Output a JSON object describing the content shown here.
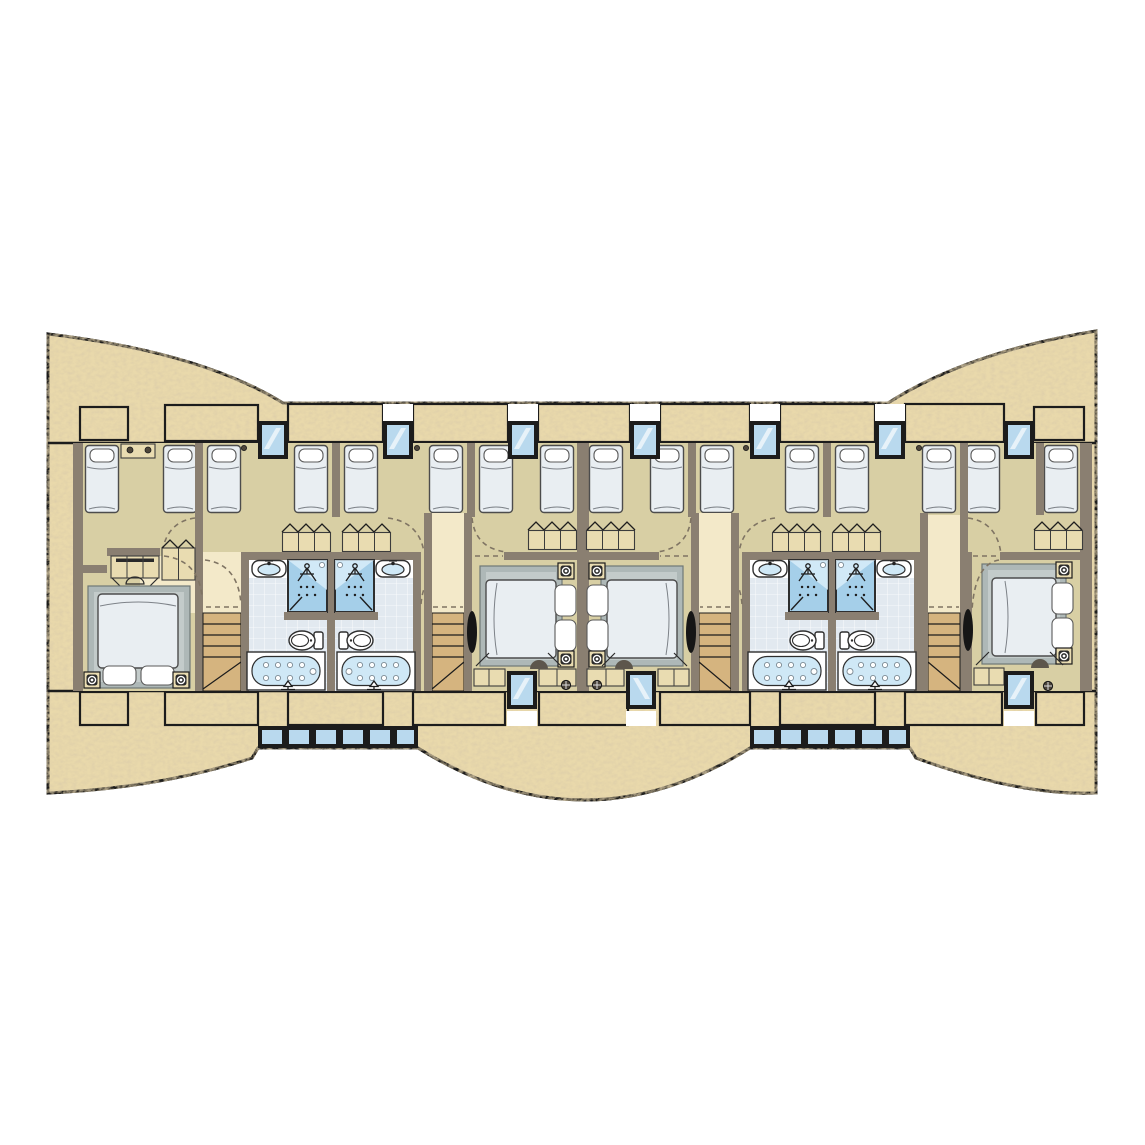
{
  "document": {
    "kind": "architectural-floor-plan",
    "level": "chalet bedroom storey",
    "aria": "Floor plan of a terraced chalet bedroom level with four units",
    "units": 4
  },
  "colors": {
    "paper": "#ffffff",
    "line": "#1c1c1c",
    "sand": "#e9d9ab",
    "sanddk": "#bfa273",
    "wall": "#8a7f71",
    "floor": "#d8cfa4",
    "corridor": "#f3e9c9",
    "stair": "#d5b47f",
    "tile": "#e2e9f0",
    "glass": "#b9d9ee",
    "tub": "#cfe8f6",
    "shower": "#a5cfe9",
    "bed": "#e9eef2",
    "rug": "#aeb8b7",
    "rugin": "#c3cbca",
    "woodlite": "#e9dcb1",
    "dash": "#7f7463"
  },
  "inventory": {
    "single_beds": 16,
    "double_beds": 4,
    "bathrooms": 4,
    "showers": 4,
    "bathtubs": 4,
    "toilets": 4,
    "washbasins": 4,
    "staircases": 4,
    "wardrobes": 8,
    "dressing_tables": 1,
    "top_facade_windows": 7,
    "bottom_facade_windows": 3,
    "curved_bay_window_strips": 2,
    "door_swings": 12
  }
}
